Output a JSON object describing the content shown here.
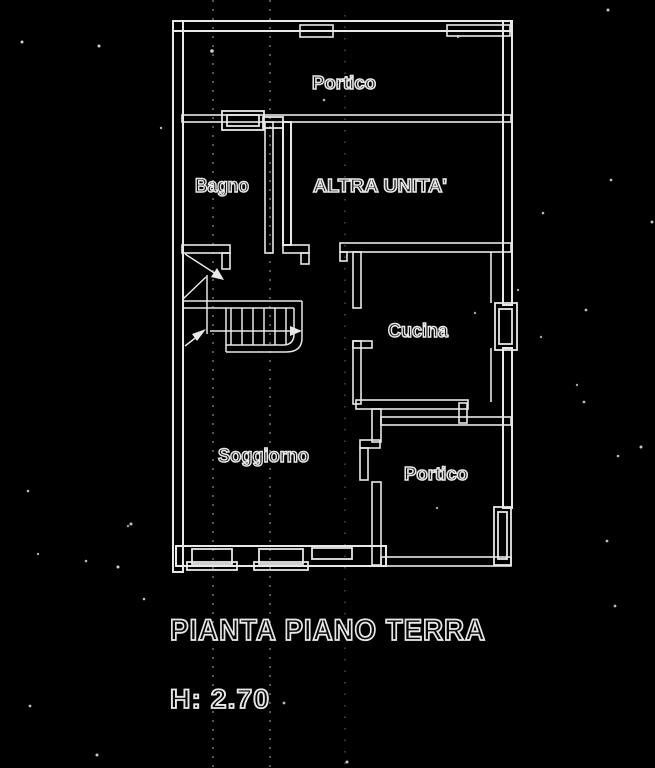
{
  "plan": {
    "colors": {
      "background": "#000000",
      "line": "#e8e8e8",
      "artifact": "#8f8f8f"
    },
    "labels": {
      "portico_top": "Portico",
      "bagno": "Bagno",
      "altra_unita": "ALTRA UNITA'",
      "cucina": "Cucina",
      "soggiorno": "Soggiorno",
      "portico_lower": "Portico"
    },
    "title": "PIANTA PIANO TERRA",
    "height_label": "H: 2.70"
  }
}
